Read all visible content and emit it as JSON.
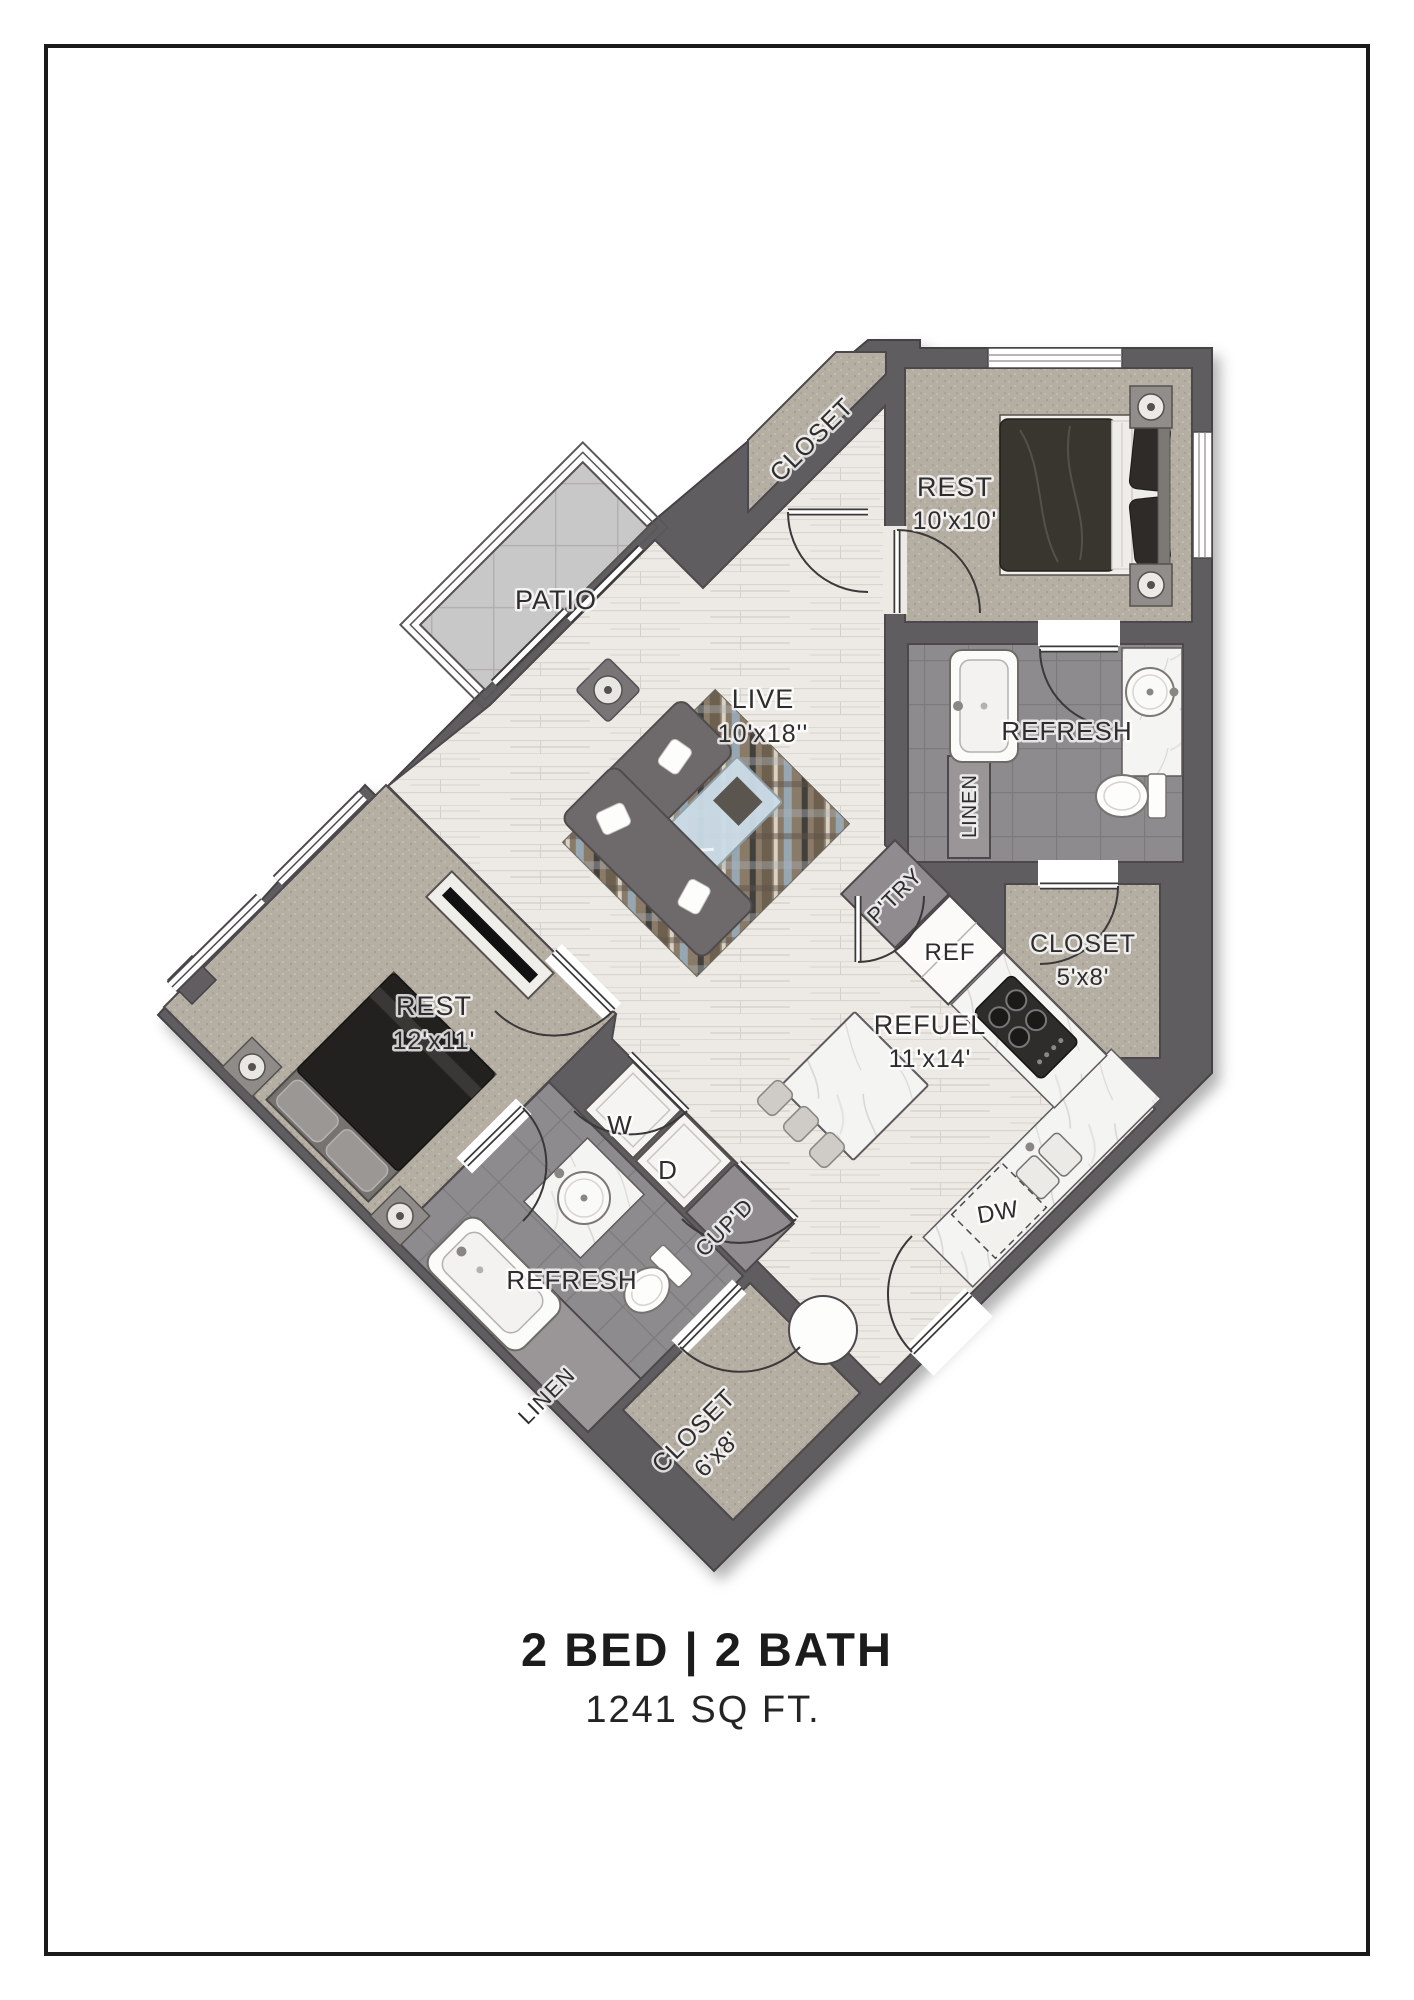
{
  "plan": {
    "rooms": {
      "patio": {
        "label": "PATIO"
      },
      "entry_closet": {
        "label": "CLOSET"
      },
      "bedroom_1": {
        "label": "REST",
        "dims": "10'x10'"
      },
      "living": {
        "label": "LIVE",
        "dims": "10'x18''"
      },
      "bath_1": {
        "label": "REFRESH"
      },
      "linen_1": {
        "label": "LINEN"
      },
      "pantry": {
        "label": "P'TRY"
      },
      "fridge": {
        "label": "REF"
      },
      "closet_1": {
        "label": "CLOSET",
        "dims": "5'x8'"
      },
      "bedroom_2": {
        "label": "REST",
        "dims": "12'x11'"
      },
      "kitchen": {
        "label": "REFUEL",
        "dims": "11'x14'"
      },
      "washer": {
        "label": "W"
      },
      "dryer": {
        "label": "D"
      },
      "cupboard": {
        "label": "CUP'D"
      },
      "dishwasher": {
        "label": "DW"
      },
      "bath_2": {
        "label": "REFRESH"
      },
      "linen_2": {
        "label": "LINEN"
      },
      "closet_2": {
        "label": "CLOSET",
        "dims": "6'x8'"
      }
    }
  },
  "caption": {
    "title": "2 BED | 2 BATH",
    "area": "1241 SQ FT."
  },
  "colors": {
    "wall": "#615d60",
    "wood_floor": "#edeae6",
    "carpet": "#b5aea3",
    "bath_tile": "#8d8b8d",
    "marble": "#f4f4f3",
    "patio_tile": "#c9c8c8",
    "frame": "#1a1a1a",
    "label_text": "#2e2c2d"
  }
}
